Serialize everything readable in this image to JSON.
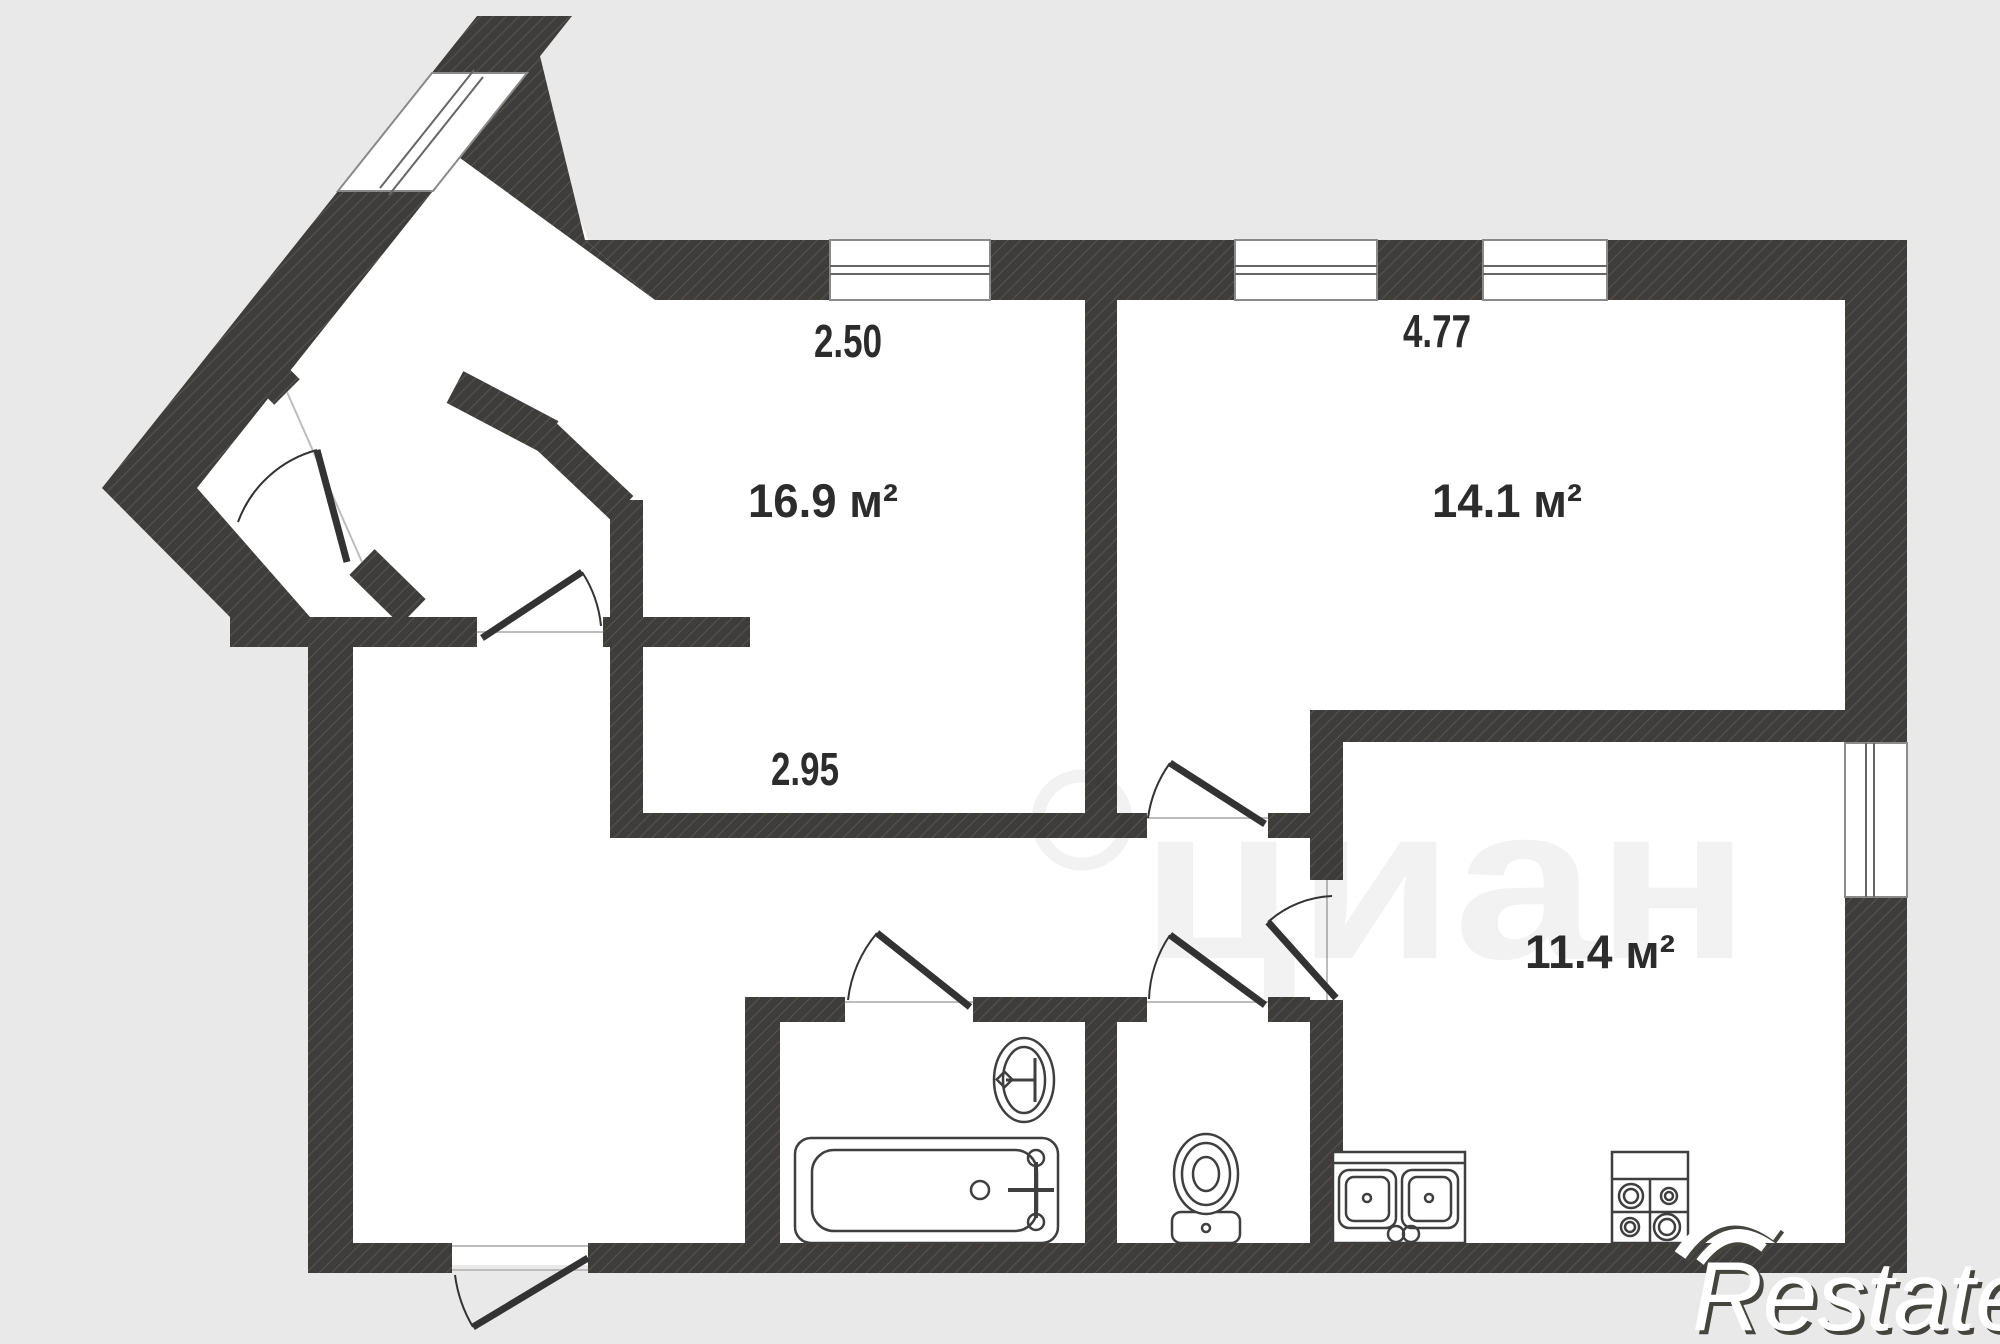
{
  "plan_title": "apartment floor plan",
  "colors": {
    "background": "#e9e9e9",
    "wall": "#3e3d3c",
    "hatch_line": "#56534e",
    "room_fill": "#ffffff",
    "fixture_line": "#3f3f3f",
    "label_text": "#2c2c2c",
    "window_frame": "#8a8a8a"
  },
  "rooms": [
    {
      "id": "room-1",
      "area": "16.9 м²"
    },
    {
      "id": "room-2",
      "area": "14.1 м²"
    },
    {
      "id": "room-kitchen",
      "area": "11.4 м²"
    }
  ],
  "dimensions": [
    {
      "value": "2.50"
    },
    {
      "value": "4.77"
    },
    {
      "value": "2.95"
    }
  ],
  "fixtures": [
    "bathtub",
    "wash-basin",
    "toilet",
    "kitchen-sink",
    "stove"
  ],
  "watermarks": {
    "center_text": "циан",
    "brand_text": "Restate"
  }
}
